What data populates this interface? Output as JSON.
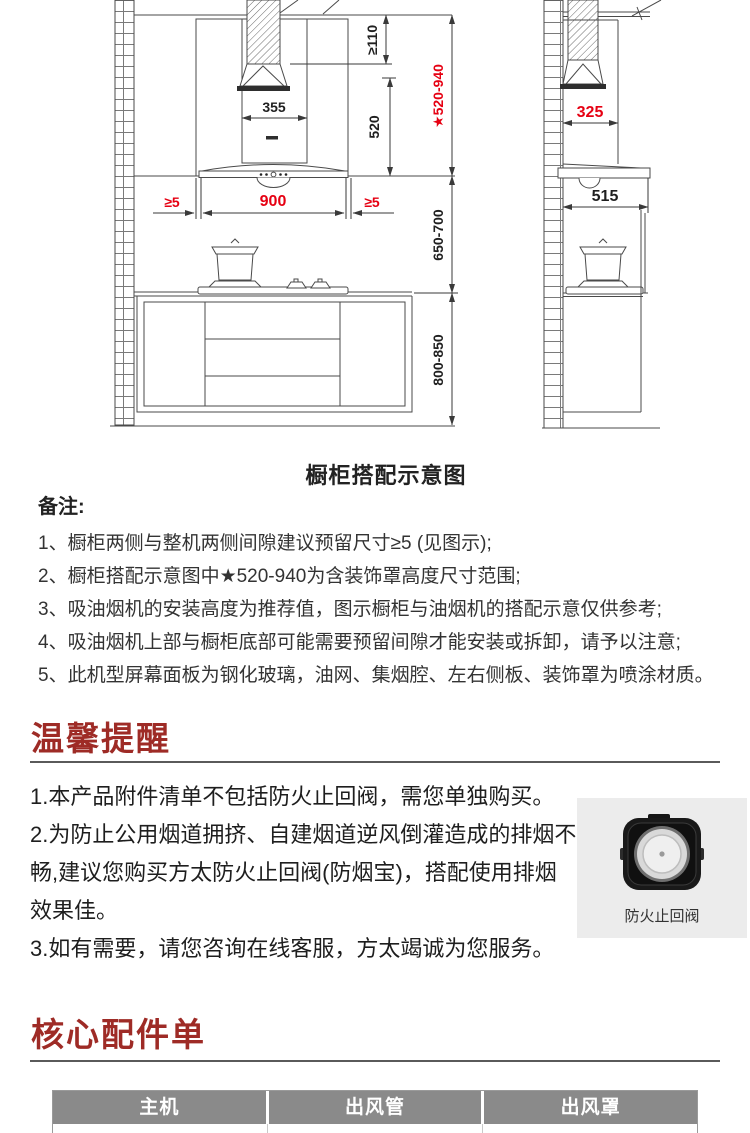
{
  "diagram": {
    "title": "橱柜搭配示意图",
    "dims": {
      "top_clearance": "≥110",
      "chimney_width": "355",
      "chimney_height": "520",
      "star_height_range": "★520-940",
      "hood_width": "900",
      "side_gap_left": "≥5",
      "side_gap_right": "≥5",
      "hood_to_counter": "650-700",
      "counter_height": "800-850",
      "side_chimney_width": "325",
      "hood_depth": "515"
    }
  },
  "notes": {
    "label": "备注:",
    "items": [
      "1、橱柜两侧与整机两侧间隙建议预留尺寸≥5 (见图示);",
      "2、橱柜搭配示意图中★520-940为含装饰罩高度尺寸范围;",
      "3、吸油烟机的安装高度为推荐值，图示橱柜与油烟机的搭配示意仅供参考;",
      "4、吸油烟机上部与橱柜底部可能需要预留间隙才能安装或拆卸，请予以注意;",
      "5、此机型屏幕面板为钢化玻璃，油网、集烟腔、左右侧板、装饰罩为喷涂材质。"
    ]
  },
  "reminder": {
    "heading": "温馨提醒",
    "lines": [
      "1.本产品附件清单不包括防火止回阀，需您单独购买。",
      "2.为防止公用烟道拥挤、自建烟道逆风倒灌造成的排烟不畅,建议您购买方太防火止回阀(防烟宝)，搭配使用排烟效果佳。",
      "3.如有需要，请您咨询在线客服，方太竭诚为您服务。"
    ],
    "accessory_caption": "防火止回阀"
  },
  "accessories": {
    "heading": "核心配件单",
    "table_headers": [
      "主机",
      "出风管",
      "出风罩"
    ]
  },
  "colors": {
    "heading_red": "#9e2b26",
    "dimension_red": "#e60012",
    "table_header_bg": "#8a8a8a"
  }
}
